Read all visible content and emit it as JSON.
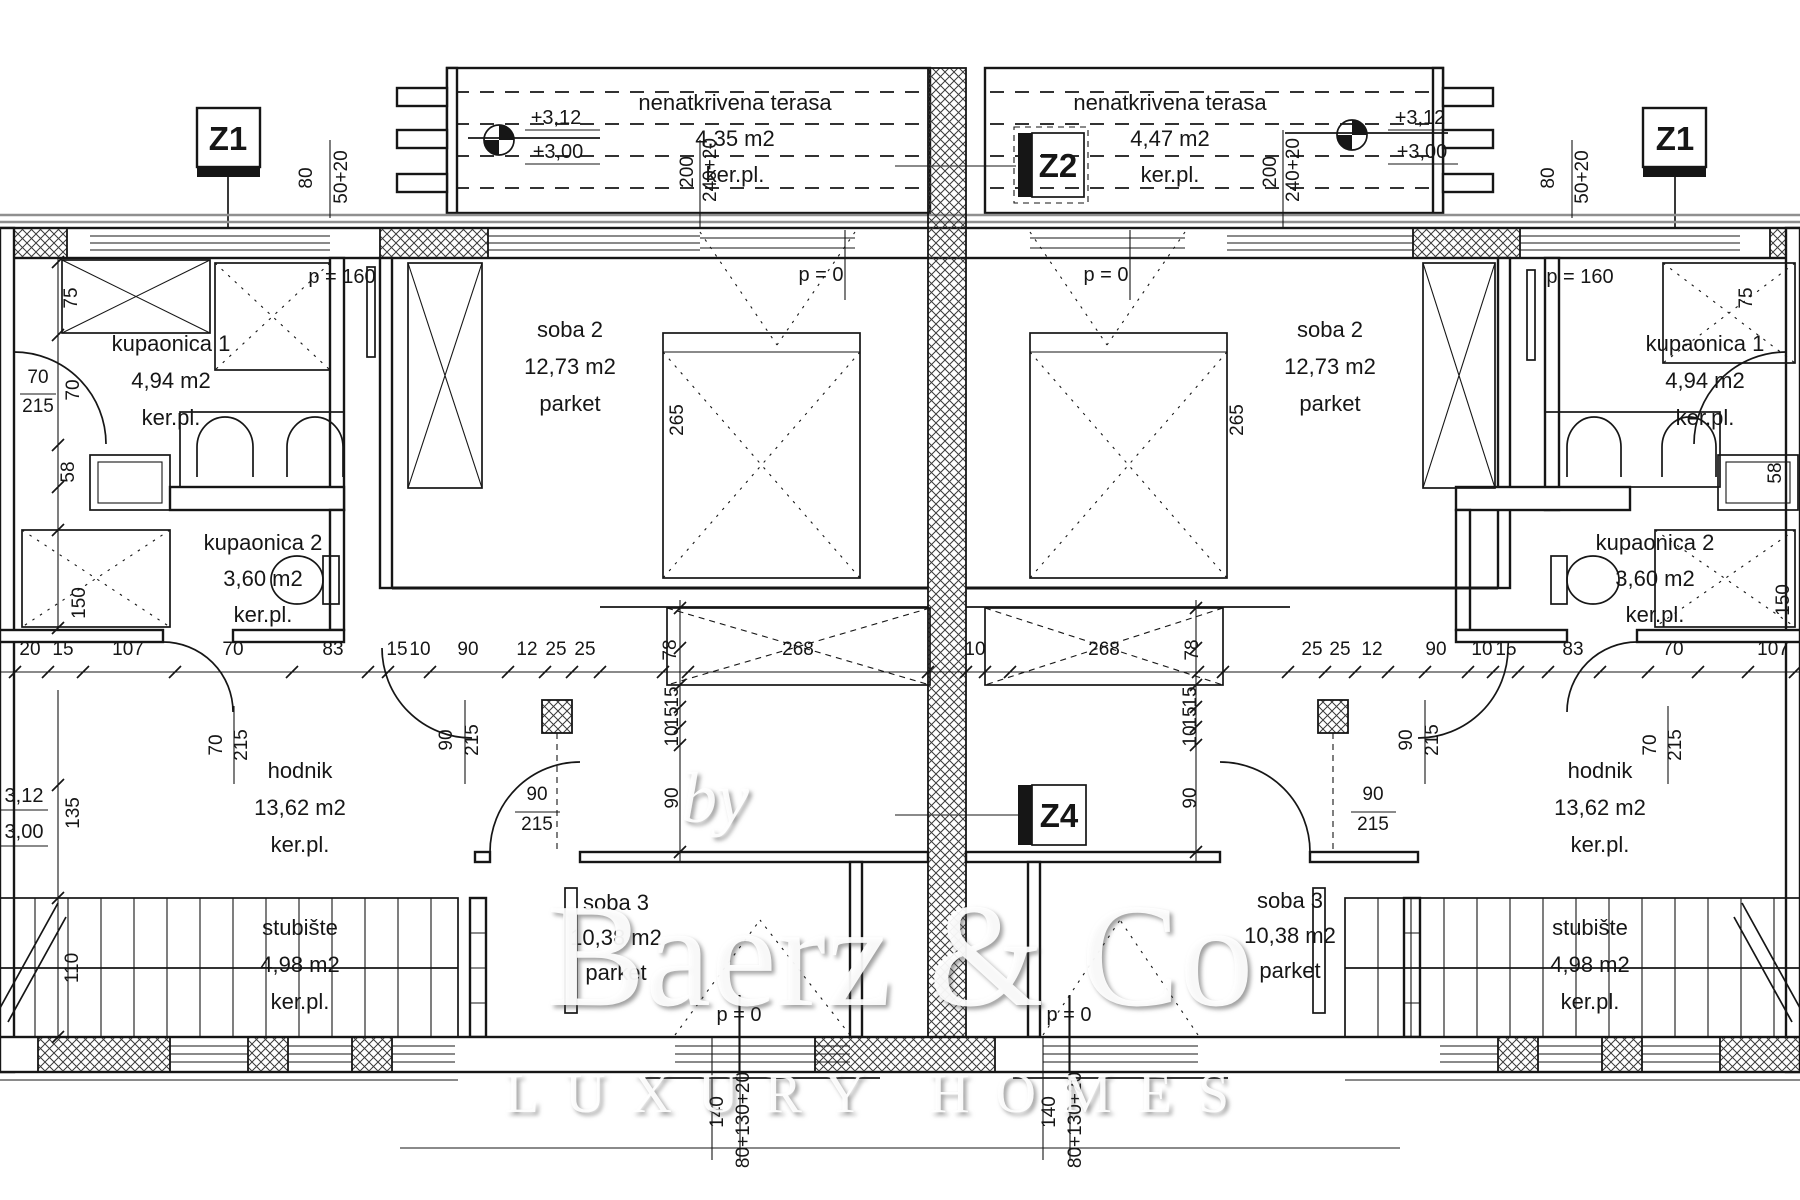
{
  "watermark": {
    "prefix": "by",
    "brand": "Baerz & Co",
    "tagline": "LUXURY HOMES"
  },
  "zones": {
    "z1": "Z1",
    "z2": "Z2",
    "z4": "Z4"
  },
  "colors": {
    "line": "#161616",
    "watermark": "#ffffff",
    "background": "#ffffff"
  },
  "rooms": [
    {
      "name": "kupaonica 1",
      "area": "4,94 m2",
      "floor": "ker.pl.",
      "x": 171,
      "y": 351,
      "lh": 37
    },
    {
      "name": "soba 2",
      "area": "12,73 m2",
      "floor": "parket",
      "x": 570,
      "y": 337,
      "lh": 37
    },
    {
      "name": "kupaonica 2",
      "area": "3,60 m2",
      "floor": "ker.pl.",
      "x": 263,
      "y": 550,
      "lh": 36
    },
    {
      "name": "hodnik",
      "area": "13,62 m2",
      "floor": "ker.pl.",
      "x": 300,
      "y": 778,
      "lh": 37
    },
    {
      "name": "stubište",
      "area": "4,98 m2",
      "floor": "ker.pl.",
      "x": 300,
      "y": 935,
      "lh": 37
    },
    {
      "name": "soba 3",
      "area": "10,38 m2",
      "floor": "parket",
      "x": 616,
      "y": 910,
      "lh": 35
    },
    {
      "name": "soba 2",
      "area": "12,73 m2",
      "floor": "parket",
      "x": 1330,
      "y": 337,
      "lh": 37
    },
    {
      "name": "kupaonica 1",
      "area": "4,94 m2",
      "floor": "ker.pl.",
      "x": 1705,
      "y": 351,
      "lh": 37
    },
    {
      "name": "kupaonica 2",
      "area": "3,60 m2",
      "floor": "ker.pl.",
      "x": 1655,
      "y": 550,
      "lh": 36
    },
    {
      "name": "hodnik",
      "area": "13,62 m2",
      "floor": "ker.pl.",
      "x": 1600,
      "y": 778,
      "lh": 37
    },
    {
      "name": "stubište",
      "area": "4,98 m2",
      "floor": "ker.pl.",
      "x": 1590,
      "y": 935,
      "lh": 37
    },
    {
      "name": "soba 3",
      "area": "10,38 m2",
      "floor": "parket",
      "x": 1290,
      "y": 908,
      "lh": 35
    },
    {
      "name": "nenatkrivena terasa",
      "area": "4,35 m2",
      "floor": "ker.pl.",
      "x": 735,
      "y": 110,
      "lh": 36
    },
    {
      "name": "nenatkrivena terasa",
      "area": "4,47 m2",
      "floor": "ker.pl.",
      "x": 1170,
      "y": 110,
      "lh": 36
    }
  ],
  "dims": [
    {
      "t": "80",
      "x": 312,
      "y": 178,
      "r": -90
    },
    {
      "t": "50+20",
      "x": 347,
      "y": 177,
      "r": -90
    },
    {
      "t": "200",
      "x": 693,
      "y": 172,
      "r": -90
    },
    {
      "t": "240+20",
      "x": 716,
      "y": 170,
      "r": -90
    },
    {
      "t": "200",
      "x": 1276,
      "y": 172,
      "r": -90
    },
    {
      "t": "240+20",
      "x": 1299,
      "y": 170,
      "r": -90
    },
    {
      "t": "80",
      "x": 1554,
      "y": 178,
      "r": -90
    },
    {
      "t": "50+20",
      "x": 1588,
      "y": 177,
      "r": -90
    },
    {
      "t": "+3,12",
      "x": 556,
      "y": 124
    },
    {
      "t": "+3,00",
      "x": 558,
      "y": 158
    },
    {
      "t": "+3,12",
      "x": 1420,
      "y": 124
    },
    {
      "t": "+3,00",
      "x": 1422,
      "y": 158
    },
    {
      "t": "75",
      "x": 77,
      "y": 298,
      "r": -90
    },
    {
      "t": "70",
      "x": 79,
      "y": 390,
      "r": -90
    },
    {
      "t": "58",
      "x": 74,
      "y": 472,
      "r": -90
    },
    {
      "t": "150",
      "x": 85,
      "y": 603,
      "r": -90
    },
    {
      "t": "135",
      "x": 79,
      "y": 813,
      "r": -90
    },
    {
      "t": "110",
      "x": 78,
      "y": 968,
      "r": -90
    },
    {
      "t": "70",
      "x": 38,
      "y": 383
    },
    {
      "t": "215",
      "x": 38,
      "y": 412
    },
    {
      "t": "3,12",
      "x": 24,
      "y": 802
    },
    {
      "t": "3,00",
      "x": 24,
      "y": 838
    },
    {
      "t": "20",
      "x": 30,
      "y": 655
    },
    {
      "t": "15",
      "x": 63,
      "y": 655
    },
    {
      "t": "107",
      "x": 128,
      "y": 655
    },
    {
      "t": "70",
      "x": 233,
      "y": 655
    },
    {
      "t": "83",
      "x": 333,
      "y": 655
    },
    {
      "t": "15",
      "x": 397,
      "y": 655
    },
    {
      "t": "10",
      "x": 420,
      "y": 655
    },
    {
      "t": "90",
      "x": 468,
      "y": 655
    },
    {
      "t": "12",
      "x": 527,
      "y": 655
    },
    {
      "t": "25",
      "x": 556,
      "y": 655
    },
    {
      "t": "25",
      "x": 585,
      "y": 655
    },
    {
      "t": "78",
      "x": 676,
      "y": 650,
      "r": -90
    },
    {
      "t": "268",
      "x": 798,
      "y": 655
    },
    {
      "t": "10",
      "x": 975,
      "y": 655
    },
    {
      "t": "268",
      "x": 1104,
      "y": 655
    },
    {
      "t": "78",
      "x": 1198,
      "y": 650,
      "r": -90
    },
    {
      "t": "25",
      "x": 1312,
      "y": 655
    },
    {
      "t": "25",
      "x": 1340,
      "y": 655
    },
    {
      "t": "12",
      "x": 1372,
      "y": 655
    },
    {
      "t": "90",
      "x": 1436,
      "y": 655
    },
    {
      "t": "10",
      "x": 1482,
      "y": 655
    },
    {
      "t": "15",
      "x": 1506,
      "y": 655
    },
    {
      "t": "83",
      "x": 1573,
      "y": 655
    },
    {
      "t": "70",
      "x": 1673,
      "y": 655
    },
    {
      "t": "107",
      "x": 1773,
      "y": 655
    },
    {
      "t": "75",
      "x": 1752,
      "y": 298,
      "r": -90
    },
    {
      "t": "58",
      "x": 1781,
      "y": 473,
      "r": -90
    },
    {
      "t": "150",
      "x": 1789,
      "y": 600,
      "r": -90
    },
    {
      "t": "70",
      "x": 222,
      "y": 745,
      "r": -90
    },
    {
      "t": "215",
      "x": 247,
      "y": 745,
      "r": -90
    },
    {
      "t": "90",
      "x": 452,
      "y": 740,
      "r": -90
    },
    {
      "t": "215",
      "x": 478,
      "y": 740,
      "r": -90
    },
    {
      "t": "90",
      "x": 1412,
      "y": 740,
      "r": -90
    },
    {
      "t": "215",
      "x": 1438,
      "y": 740,
      "r": -90
    },
    {
      "t": "70",
      "x": 1656,
      "y": 745,
      "r": -90
    },
    {
      "t": "215",
      "x": 1681,
      "y": 745,
      "r": -90
    },
    {
      "t": "90",
      "x": 537,
      "y": 800
    },
    {
      "t": "215",
      "x": 537,
      "y": 830
    },
    {
      "t": "90",
      "x": 1373,
      "y": 800
    },
    {
      "t": "215",
      "x": 1373,
      "y": 830
    },
    {
      "t": "15",
      "x": 678,
      "y": 697,
      "r": -90
    },
    {
      "t": "15",
      "x": 678,
      "y": 717,
      "r": -90
    },
    {
      "t": "10",
      "x": 678,
      "y": 736,
      "r": -90
    },
    {
      "t": "90",
      "x": 678,
      "y": 798,
      "r": -90
    },
    {
      "t": "15",
      "x": 1196,
      "y": 697,
      "r": -90
    },
    {
      "t": "15",
      "x": 1196,
      "y": 717,
      "r": -90
    },
    {
      "t": "10",
      "x": 1196,
      "y": 736,
      "r": -90
    },
    {
      "t": "90",
      "x": 1196,
      "y": 798,
      "r": -90
    },
    {
      "t": "265",
      "x": 683,
      "y": 420,
      "r": -90
    },
    {
      "t": "265",
      "x": 1243,
      "y": 420,
      "r": -90
    },
    {
      "t": "140",
      "x": 723,
      "y": 1112,
      "r": -90
    },
    {
      "t": "80+130+20",
      "x": 749,
      "y": 1120,
      "r": -90
    },
    {
      "t": "140",
      "x": 1055,
      "y": 1112,
      "r": -90
    },
    {
      "t": "80+130+20",
      "x": 1081,
      "y": 1120,
      "r": -90
    },
    {
      "t": "p = 160",
      "x": 342,
      "y": 283
    },
    {
      "t": "p = 0",
      "x": 821,
      "y": 281
    },
    {
      "t": "p = 0",
      "x": 1106,
      "y": 281
    },
    {
      "t": "p = 160",
      "x": 1580,
      "y": 283
    },
    {
      "t": "p = 0",
      "x": 739,
      "y": 1021
    },
    {
      "t": "p = 0",
      "x": 1069,
      "y": 1021
    }
  ]
}
